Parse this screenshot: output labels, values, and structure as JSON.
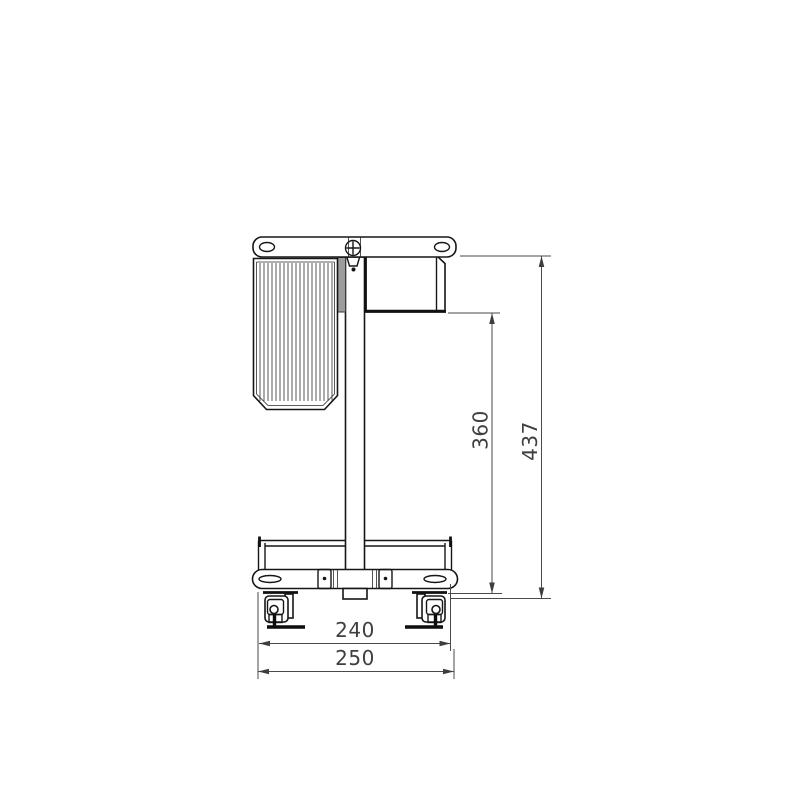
{
  "drawing": {
    "description": "Orthographic side elevation of a mobile caster cart: top mounting plate with slotted holes and centre screw, ribbed housing, vertical column, side box, lower tray on slotted base plate, two swivel casters",
    "dimension_labels": {
      "inner_height": "360",
      "overall_height": "437",
      "inner_width": "240",
      "overall_width": "250"
    },
    "colors": {
      "background": "#ffffff",
      "object_line": "#161616",
      "dimension_line": "#4a4a4a",
      "shading": "#9c9c9c"
    }
  }
}
